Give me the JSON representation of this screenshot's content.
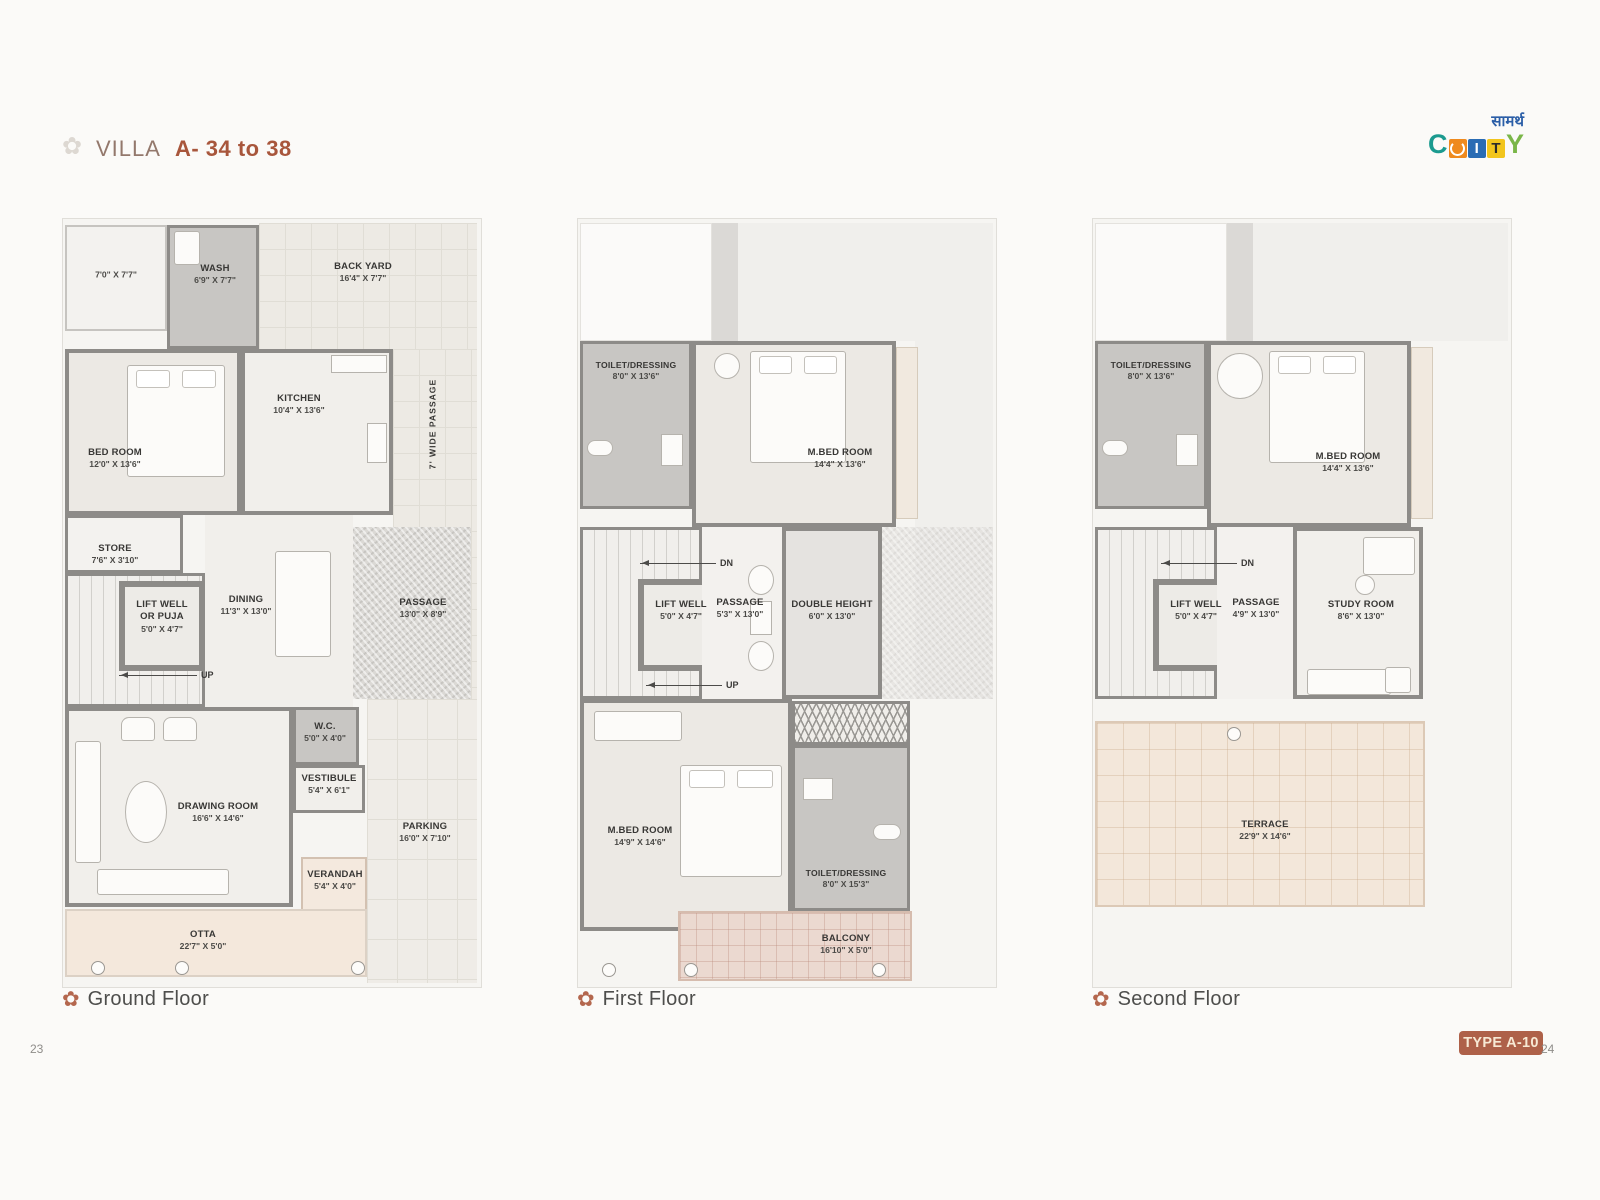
{
  "header": {
    "title_prefix": "VILLA",
    "title_range": "A- 34 to 38",
    "logo": {
      "hindi": "सामर्थ",
      "c": "C",
      "i": "I",
      "t": "T",
      "y": "Y"
    }
  },
  "colors": {
    "accent": "#a8563c",
    "badge_bg": "#ae6149",
    "logo_blue": "#2b5ea7",
    "logo_teal": "#1b9a8f",
    "logo_orange": "#ef8a1e",
    "logo_yellow": "#f2c51d",
    "logo_green": "#7ab648"
  },
  "plans": {
    "ground": {
      "label": "Ground Floor",
      "rooms": {
        "open_area": {
          "name": "",
          "dims": "7'0\" X 7'7\""
        },
        "wash": {
          "name": "WASH",
          "dims": "6'9\" X 7'7\""
        },
        "back_yard": {
          "name": "BACK YARD",
          "dims": "16'4\" X 7'7\""
        },
        "wide_passage": {
          "name": "7' WIDE PASSAGE"
        },
        "kitchen": {
          "name": "KITCHEN",
          "dims": "10'4\" X 13'6\""
        },
        "bed_room": {
          "name": "BED ROOM",
          "dims": "12'0\" X 13'6\""
        },
        "store": {
          "name": "STORE",
          "dims": "7'6\" X 3'10\""
        },
        "lift_well": {
          "name": "LIFT WELL",
          "line2": "OR  PUJA",
          "dims": "5'0\" X 4'7\""
        },
        "dining": {
          "name": "DINING",
          "dims": "11'3\" X 13'0\""
        },
        "passage": {
          "name": "PASSAGE",
          "dims": "13'0\" X 8'9\""
        },
        "wc": {
          "name": "W.C.",
          "dims": "5'0\" X 4'0\""
        },
        "vestibule": {
          "name": "VESTIBULE",
          "dims": "5'4\" X 6'1\""
        },
        "drawing_room": {
          "name": "DRAWING ROOM",
          "dims": "16'6\" X 14'6\""
        },
        "parking": {
          "name": "PARKING",
          "dims": "16'0\" X 7'10\""
        },
        "verandah": {
          "name": "VERANDAH",
          "dims": "5'4\" X 4'0\""
        },
        "otta": {
          "name": "OTTA",
          "dims": "22'7\" X 5'0\""
        }
      },
      "arrows": {
        "up": "UP"
      }
    },
    "first": {
      "label": "First Floor",
      "rooms": {
        "toilet_top": {
          "name": "TOILET/DRESSING",
          "dims": "8'0\" X 13'6\""
        },
        "mbed_top": {
          "name": "M.BED ROOM",
          "dims": "14'4\" X 13'6\""
        },
        "lift_well": {
          "name": "LIFT WELL",
          "dims": "5'0\" X 4'7\""
        },
        "passage": {
          "name": "PASSAGE",
          "dims": "5'3\" X 13'0\""
        },
        "double_height": {
          "name": "DOUBLE HEIGHT",
          "dims": "6'0\" X 13'0\""
        },
        "mbed_bottom": {
          "name": "M.BED ROOM",
          "dims": "14'9\" X 14'6\""
        },
        "toilet_bottom": {
          "name": "TOILET/DRESSING",
          "dims": "8'0\" X 15'3\""
        },
        "balcony": {
          "name": "BALCONY",
          "dims": "16'10\" X 5'0\""
        }
      },
      "arrows": {
        "dn": "DN",
        "up": "UP"
      }
    },
    "second": {
      "label": "Second Floor",
      "rooms": {
        "toilet_top": {
          "name": "TOILET/DRESSING",
          "dims": "8'0\" X 13'6\""
        },
        "mbed_top": {
          "name": "M.BED ROOM",
          "dims": "14'4\" X 13'6\""
        },
        "lift_well": {
          "name": "LIFT WELL",
          "dims": "5'0\" X 4'7\""
        },
        "passage": {
          "name": "PASSAGE",
          "dims": "4'9\" X 13'0\""
        },
        "study_room": {
          "name": "STUDY ROOM",
          "dims": "8'6\" X 13'0\""
        },
        "terrace": {
          "name": "TERRACE",
          "dims": "22'9\" X 14'6\""
        }
      },
      "arrows": {
        "dn": "DN"
      }
    }
  },
  "footer": {
    "type_badge": "TYPE A-10",
    "page_left": "23",
    "page_right": "24"
  }
}
